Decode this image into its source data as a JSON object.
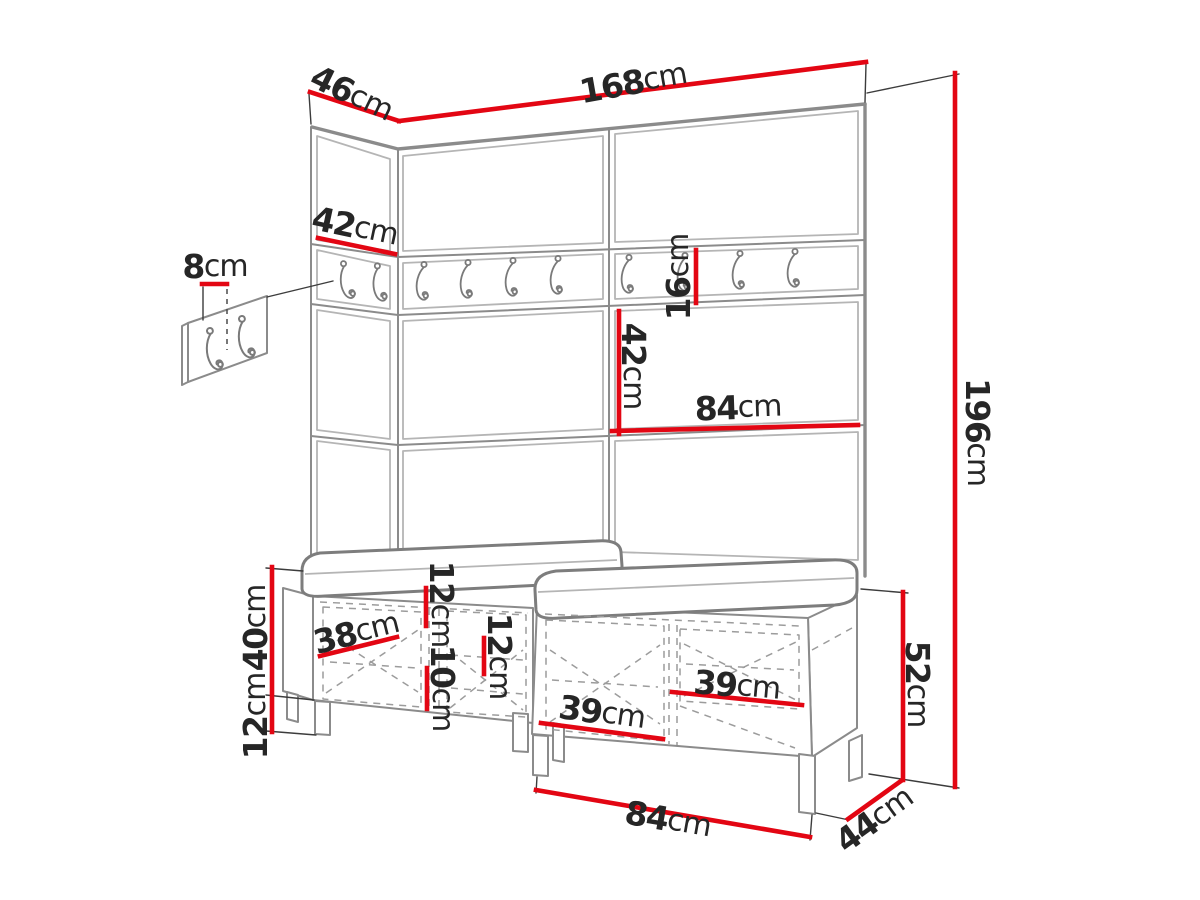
{
  "drawing": {
    "description": "Hallway wardrobe wall-panel set with coat hooks and two shoe benches - dimensioned technical sketch",
    "unit": "cm",
    "colors": {
      "dimension_line": "#e30613",
      "furniture_outline": "#8b8b8b",
      "extension_line": "#3c3c3c",
      "label_text": "#262626",
      "background": "#ffffff"
    },
    "dimensions": {
      "total_width": {
        "value": "168",
        "unit": "cm"
      },
      "total_depth": {
        "value": "46",
        "unit": "cm"
      },
      "left_panel_width": {
        "value": "42",
        "unit": "cm"
      },
      "hook_panel_height": {
        "value": "8",
        "unit": "cm"
      },
      "hook_rail_height": {
        "value": "16",
        "unit": "cm"
      },
      "panel_row_height": {
        "value": "42",
        "unit": "cm"
      },
      "panel_column_width": {
        "value": "84",
        "unit": "cm"
      },
      "total_height": {
        "value": "196",
        "unit": "cm"
      },
      "bench_body_height": {
        "value": "40",
        "unit": "cm"
      },
      "bench_leg_height": {
        "value": "12",
        "unit": "cm"
      },
      "bench_shelf_depth": {
        "value": "38",
        "unit": "cm"
      },
      "bench_top_gap": {
        "value": "12",
        "unit": "cm"
      },
      "bench_bottom_gap": {
        "value": "10",
        "unit": "cm"
      },
      "bench_right_gap": {
        "value": "12",
        "unit": "cm"
      },
      "bench_left_door_width": {
        "value": "39",
        "unit": "cm"
      },
      "bench_right_door_width": {
        "value": "39",
        "unit": "cm"
      },
      "bench_total_height": {
        "value": "52",
        "unit": "cm"
      },
      "bench_depth": {
        "value": "44",
        "unit": "cm"
      },
      "bench_width": {
        "value": "84",
        "unit": "cm"
      }
    }
  }
}
